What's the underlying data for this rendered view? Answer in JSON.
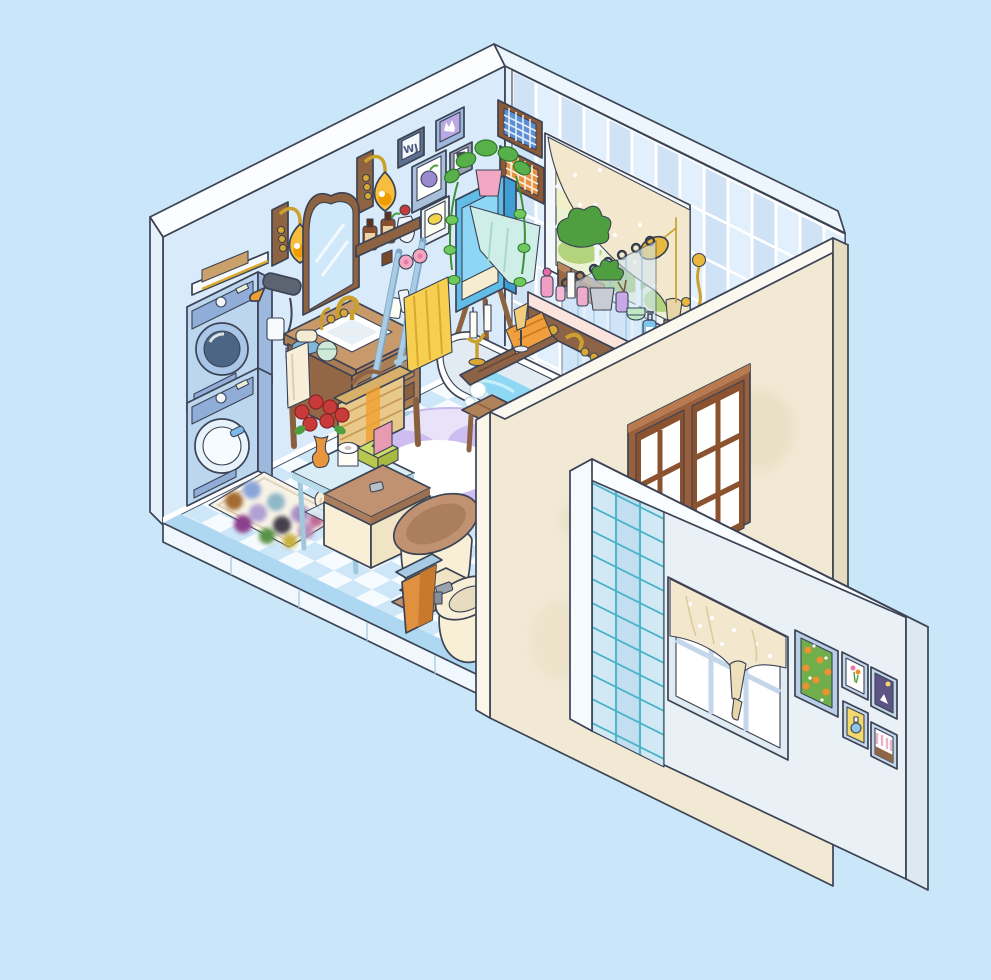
{
  "scene": {
    "type": "isometric cutaway room illustration",
    "room": "blue-and-cream bathroom with laundry corner",
    "view": "dollhouse cutaway, front walls removed / shown from outside"
  },
  "art": {
    "monogram": "WJ",
    "left_wall_frames": [
      "monogram WJ",
      "crown on lilac",
      "purple plum",
      "small photo",
      "lemon"
    ],
    "display_wall_frames": [
      "orange tree on green",
      "flower bouquet",
      "night sky with moon",
      "perfume on yellow",
      "striped cake"
    ]
  },
  "colors": {
    "bg": "#c9e7f8",
    "left_wall": "#d9ebfb",
    "back_wall": "#e4f1fc",
    "wall_band": "#fbfdff",
    "tile_a": "#cfe2f6",
    "tile_b": "#e2effc",
    "floor_white": "#f6fbff",
    "floor_blue": "#cde7f8",
    "floor_border": "#aed7f2",
    "cream_wall": "#f1e9d4",
    "cream_edge": "#e8dcc0",
    "outer_wall": "#e9f1f7",
    "outer_tile": "#cfe6f2",
    "outer_grout": "#49b4c8",
    "wood": "#a97c54",
    "wood_dark": "#8d6342",
    "gold": "#d9a833",
    "amber_shade": "#f6bd3e",
    "appliance": "#bcd6ef",
    "appliance_panel": "#8fadd6",
    "cabinet_blue": "#62bce8",
    "ladder_blue": "#aacbe4",
    "towel_yellow": "#f7cf4e",
    "towel_pink": "#f2a7c3",
    "towel_mint": "#cfeee8",
    "water": "#8fd8f4",
    "rug_lavender": "#cdbdf2",
    "rug_yellow": "#f5d76e",
    "toilet_cream": "#f8efd6",
    "toilet_tan": "#c09272",
    "bin_orange": "#e09140",
    "tissue_green": "#cddc6a",
    "rose_red": "#c93b3b",
    "vase_orange": "#e8953f",
    "curtain_cream": "#f3e8cd",
    "plant_green": "#4f9e3f",
    "frame_blue": "#c3d6ea",
    "night_purple": "#5c5484",
    "art_green": "#6fae4a",
    "art_orange": "#f09030"
  },
  "objects": {
    "laundry_area": [
      "wall shelf with towels",
      "stacked dryer",
      "stacked washer",
      "hair dryer on hook",
      "power outlet"
    ],
    "vanity_area": [
      "arched wall mirror",
      "two amber wall sconces",
      "wooden washstand with white sink",
      "gold faucet",
      "soap bars and mint jar",
      "toothbrush cup",
      "hanging hand towel",
      "shelf with amber bottles and jug vase"
    ],
    "bath_area": [
      "tiled back wall",
      "window with dotted cream curtain",
      "window planter",
      "blue gingham wall basket",
      "orange gingham wall basket",
      "tall blue cabinet with trailing pothos and mint towel",
      "blue ladder towel rack with yellow and pink towels",
      "toiletry deck with perfumes, plants, candles and shampoo bottles",
      "gold shower set",
      "wooden curtain rod with floral shower curtain",
      "white bathtub with water, caddy tray, candles and champagne",
      "wooden bath stool",
      "lavender splash rug"
    ],
    "toilet_area": [
      "glass console with roses, toilet paper, tissue box and towel rolls",
      "wicker basket",
      "cream toilet with tan lid",
      "orange waste bin with blue lid",
      "cream bidet",
      "dotted bath mat"
    ],
    "outer_walls": [
      "cream wall with brown wooden window",
      "detached display wall with aqua tiles, curtained window and five framed artworks"
    ]
  }
}
